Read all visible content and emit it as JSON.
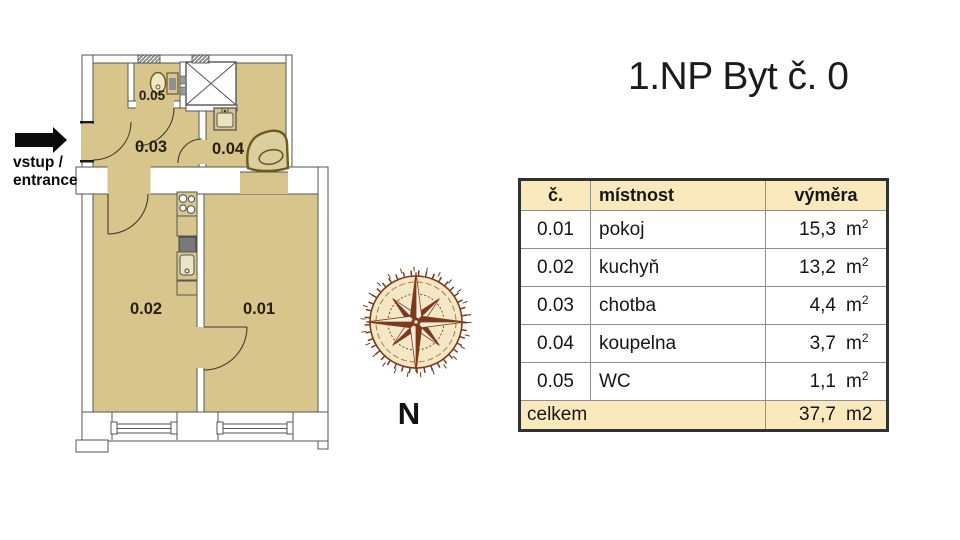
{
  "header": {
    "title": "1.NP Byt č. 0"
  },
  "entrance": {
    "line1": "vstup /",
    "line2": "entrance"
  },
  "compass": {
    "north_label": "N"
  },
  "plan": {
    "room_labels": {
      "r01": "0.01",
      "r02": "0.02",
      "r03": "0.03",
      "r04": "0.04",
      "r05": "0.05"
    }
  },
  "table": {
    "columns": [
      "č.",
      "místnost",
      "výměra"
    ],
    "rows": [
      {
        "no": "0.01",
        "room": "pokoj",
        "area": "15,3"
      },
      {
        "no": "0.02",
        "room": "kuchyň",
        "area": "13,2"
      },
      {
        "no": "0.03",
        "room": "chotba",
        "area": "4,4"
      },
      {
        "no": "0.04",
        "room": "koupelna",
        "area": "3,7"
      },
      {
        "no": "0.05",
        "room": "WC",
        "area": "1,1"
      }
    ],
    "unit": {
      "base": "m",
      "sup": "2"
    },
    "footer": {
      "label": "celkem",
      "total": "37,7",
      "unit": "m2"
    }
  },
  "colors": {
    "floor_tan": "#d7c58b",
    "wall_line": "#565656",
    "table_band": "#f9e9bd",
    "compass_brown": "#7d3a1b",
    "compass_parchment": "#f3e7c6",
    "fixture_olive": "#6b5b1c"
  }
}
